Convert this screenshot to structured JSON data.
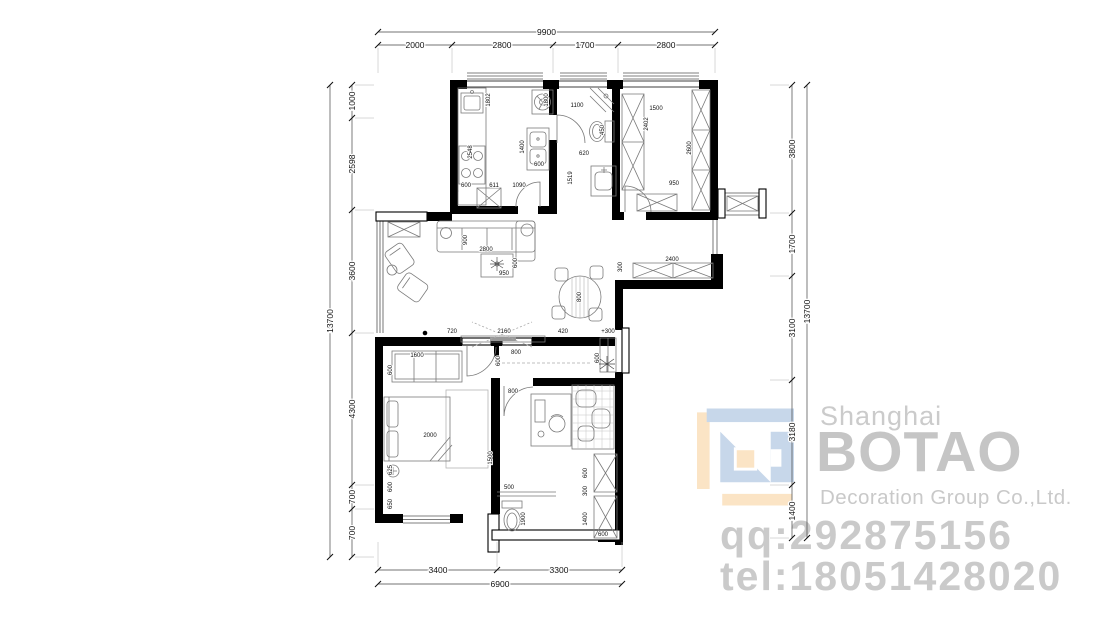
{
  "watermark": {
    "city": "Shanghai",
    "brand": "BOTAO",
    "subtitle": "Decoration Group Co.,Ltd.",
    "qq": "qq:292875156",
    "tel": "tel:18051428020",
    "colors": {
      "logo_blue": "#c7d7ea",
      "logo_tan": "#fbe4c5",
      "text": "#c8c8c8"
    }
  },
  "dimensions": {
    "top": {
      "overall_label": "9900",
      "overall_y": 32,
      "seg_y": 45,
      "x_start": 378,
      "x_end": 715,
      "ticks": [
        378,
        452,
        553,
        618,
        715
      ],
      "segments": [
        {
          "label": "2000",
          "x": 415
        },
        {
          "label": "2800",
          "x": 502
        },
        {
          "label": "1700",
          "x": 585
        },
        {
          "label": "2800",
          "x": 666
        }
      ]
    },
    "bottom": {
      "overall_label": "6900",
      "overall_y": 584,
      "seg_y": 570,
      "x_start": 378,
      "x_end": 622,
      "ticks": [
        378,
        497,
        622
      ],
      "segments": [
        {
          "label": "3400",
          "x": 438
        },
        {
          "label": "3300",
          "x": 559
        }
      ]
    },
    "left": {
      "overall_label": "13700",
      "overall_x": 330,
      "seg_x": 352,
      "y_start": 85,
      "y_end": 557,
      "ticks": [
        85,
        118,
        210,
        333,
        485,
        509,
        557
      ],
      "segments": [
        {
          "label": "1000",
          "y": 101
        },
        {
          "label": "2598",
          "y": 164
        },
        {
          "label": "3600",
          "y": 271
        },
        {
          "label": "4300",
          "y": 409
        },
        {
          "label": "700",
          "y": 497
        },
        {
          "label": "700",
          "y": 533
        }
      ]
    },
    "right": {
      "overall_label": "13700",
      "overall_x": 807,
      "seg_x": 792,
      "y_start": 85,
      "y_end": 538,
      "ticks": [
        85,
        213,
        276,
        380,
        485,
        538
      ],
      "segments": [
        {
          "label": "3800",
          "y": 149
        },
        {
          "label": "1700",
          "y": 244
        },
        {
          "label": "3100",
          "y": 328
        },
        {
          "label": "3180",
          "y": 432
        },
        {
          "label": "1400",
          "y": 511
        }
      ]
    }
  },
  "interior_labels": [
    {
      "t": "1802",
      "x": 487,
      "y": 100,
      "r": 90
    },
    {
      "t": "1800",
      "x": 545,
      "y": 100,
      "r": 90
    },
    {
      "t": "2548",
      "x": 469,
      "y": 152,
      "r": 90
    },
    {
      "t": "1400",
      "x": 521,
      "y": 147,
      "r": 90
    },
    {
      "t": "600",
      "x": 466,
      "y": 184,
      "r": 0
    },
    {
      "t": "611",
      "x": 494,
      "y": 184,
      "r": 0
    },
    {
      "t": "1090",
      "x": 519,
      "y": 184,
      "r": 0
    },
    {
      "t": "600",
      "x": 539,
      "y": 163,
      "r": 0
    },
    {
      "t": "1100",
      "x": 577,
      "y": 104,
      "r": 0
    },
    {
      "t": "450",
      "x": 601,
      "y": 130,
      "r": 90
    },
    {
      "t": "620",
      "x": 584,
      "y": 152,
      "r": 0
    },
    {
      "t": "1519",
      "x": 569,
      "y": 178,
      "r": 90
    },
    {
      "t": "1500",
      "x": 656,
      "y": 107,
      "r": 0
    },
    {
      "t": "2402",
      "x": 645,
      "y": 124,
      "r": 90
    },
    {
      "t": "2600",
      "x": 688,
      "y": 148,
      "r": 90
    },
    {
      "t": "950",
      "x": 674,
      "y": 182,
      "r": 0
    },
    {
      "t": "2400",
      "x": 672,
      "y": 258,
      "r": 0
    },
    {
      "t": "300",
      "x": 619,
      "y": 267,
      "r": 90
    },
    {
      "t": "900",
      "x": 464,
      "y": 240,
      "r": 90
    },
    {
      "t": "2800",
      "x": 486,
      "y": 248,
      "r": 0
    },
    {
      "t": "950",
      "x": 504,
      "y": 272,
      "r": 0
    },
    {
      "t": "600",
      "x": 514,
      "y": 263,
      "r": 90
    },
    {
      "t": "800",
      "x": 578,
      "y": 297,
      "r": 90
    },
    {
      "t": "720",
      "x": 452,
      "y": 330,
      "r": 0
    },
    {
      "t": "2160",
      "x": 504,
      "y": 330,
      "r": 0
    },
    {
      "t": "420",
      "x": 563,
      "y": 330,
      "r": 0
    },
    {
      "t": "600",
      "x": 497,
      "y": 361,
      "r": 90
    },
    {
      "t": "800",
      "x": 516,
      "y": 351,
      "r": 0
    },
    {
      "t": "+300",
      "x": 608,
      "y": 330,
      "r": 0
    },
    {
      "t": "600",
      "x": 596,
      "y": 358,
      "r": 90
    },
    {
      "t": "1600",
      "x": 417,
      "y": 354,
      "r": 0
    },
    {
      "t": "600",
      "x": 389,
      "y": 370,
      "r": 90
    },
    {
      "t": "2000",
      "x": 430,
      "y": 434,
      "r": 0
    },
    {
      "t": "625",
      "x": 389,
      "y": 470,
      "r": 90
    },
    {
      "t": "600",
      "x": 389,
      "y": 487,
      "r": 90
    },
    {
      "t": "650",
      "x": 389,
      "y": 504,
      "r": 90
    },
    {
      "t": "1500",
      "x": 489,
      "y": 458,
      "r": 90
    },
    {
      "t": "800",
      "x": 513,
      "y": 390,
      "r": 0
    },
    {
      "t": "500",
      "x": 509,
      "y": 486,
      "r": 0
    },
    {
      "t": "1900",
      "x": 522,
      "y": 519,
      "r": 90
    },
    {
      "t": "600",
      "x": 584,
      "y": 473,
      "r": 90
    },
    {
      "t": "300",
      "x": 584,
      "y": 491,
      "r": 90
    },
    {
      "t": "1400",
      "x": 584,
      "y": 519,
      "r": 90
    },
    {
      "t": "600",
      "x": 603,
      "y": 533,
      "r": 0
    }
  ]
}
